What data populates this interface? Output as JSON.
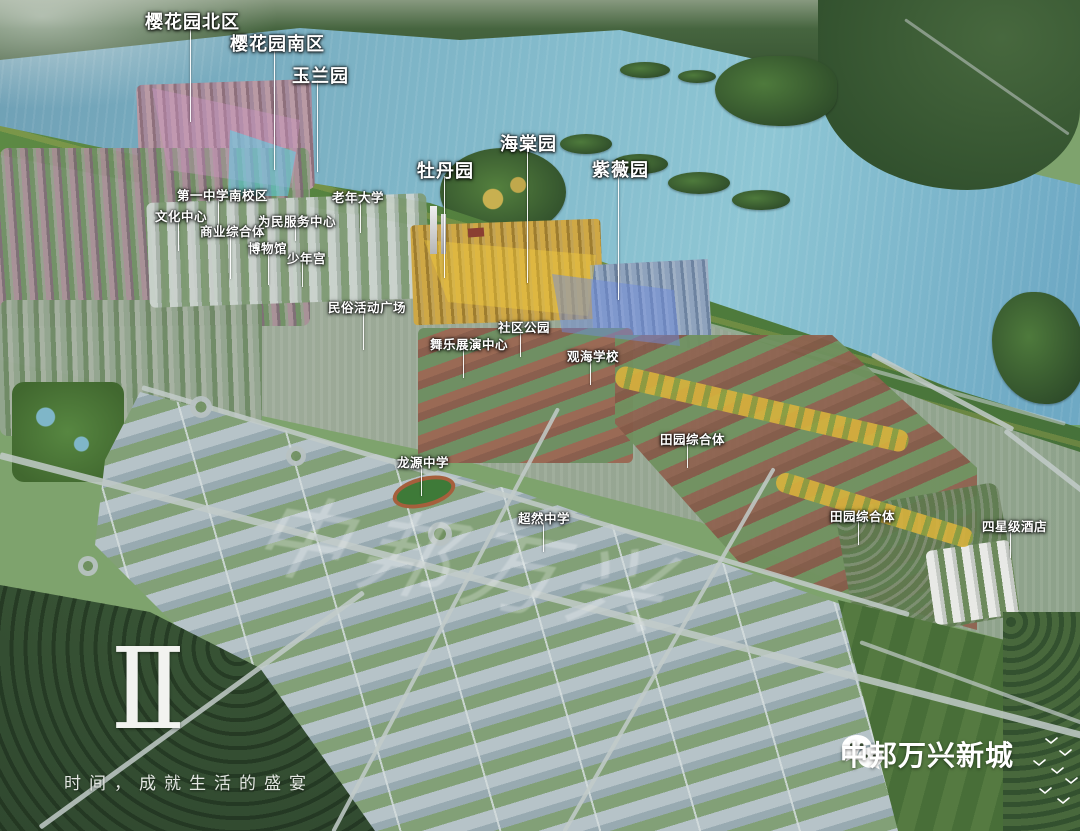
{
  "image_type": "aerial-masterplan-rendering",
  "branding": {
    "phase_numeral": "Ⅱ",
    "tagline": "时间，成就生活的盛宴",
    "wechat_name": "中邦万兴新城"
  },
  "watermark": {
    "text": "中邦万兴"
  },
  "map_labels": [
    {
      "id": "sakura-garden-north",
      "text": "樱花园北区",
      "size": "large"
    },
    {
      "id": "sakura-garden-south",
      "text": "樱花园南区",
      "size": "large"
    },
    {
      "id": "magnolia-garden",
      "text": "玉兰园",
      "size": "large"
    },
    {
      "id": "peony-garden",
      "text": "牡丹园",
      "size": "large"
    },
    {
      "id": "begonia-garden",
      "text": "海棠园",
      "size": "large"
    },
    {
      "id": "crape-myrtle-garden",
      "text": "紫薇园",
      "size": "large"
    },
    {
      "id": "no1-middle-school-south-campus",
      "text": "第一中学南校区",
      "size": "small"
    },
    {
      "id": "culture-center",
      "text": "文化中心",
      "size": "small"
    },
    {
      "id": "commercial-complex",
      "text": "商业综合体",
      "size": "small"
    },
    {
      "id": "museum",
      "text": "博物馆",
      "size": "small"
    },
    {
      "id": "youth-palace",
      "text": "少年宫",
      "size": "small"
    },
    {
      "id": "civic-service-center",
      "text": "为民服务中心",
      "size": "small"
    },
    {
      "id": "senior-university",
      "text": "老年大学",
      "size": "small"
    },
    {
      "id": "folk-activity-square",
      "text": "民俗活动广场",
      "size": "small"
    },
    {
      "id": "dance-performance-center",
      "text": "舞乐展演中心",
      "size": "small"
    },
    {
      "id": "community-park",
      "text": "社区公园",
      "size": "small"
    },
    {
      "id": "guanhai-school",
      "text": "观海学校",
      "size": "small"
    },
    {
      "id": "rural-complex-north",
      "text": "田园综合体",
      "size": "small"
    },
    {
      "id": "longyuan-middle-school",
      "text": "龙源中学",
      "size": "small"
    },
    {
      "id": "chaoran-middle-school",
      "text": "超然中学",
      "size": "small"
    },
    {
      "id": "rural-complex-south",
      "text": "田园综合体",
      "size": "small"
    },
    {
      "id": "four-star-hotel",
      "text": "四星级酒店",
      "size": "small"
    }
  ],
  "colors": {
    "water": "#7fb6c8",
    "shore_green": "#5d8a44",
    "forest_dark": "#2f4a2d",
    "industrial_roof": "#b6c3c8",
    "label_text": "#ffffff",
    "highlight_cyan": "#58d8eb",
    "highlight_gold": "#f4cc3c",
    "highlight_blue": "#6e8ce0",
    "highlight_mauve": "#cf97c4"
  }
}
